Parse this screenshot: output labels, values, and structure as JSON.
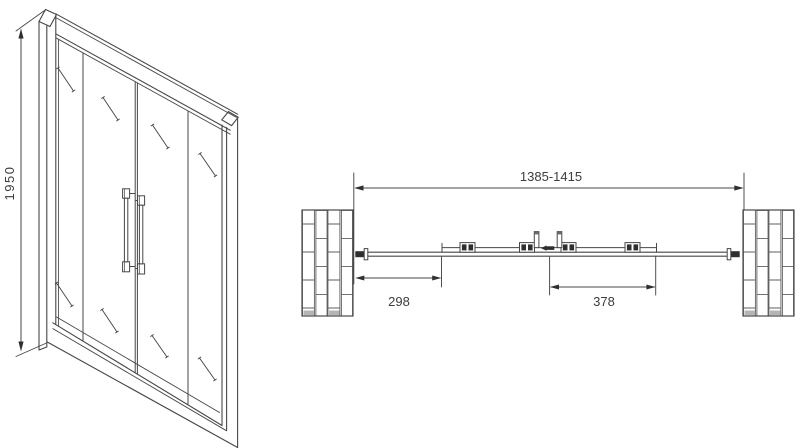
{
  "drawing": {
    "colors": {
      "background": "#ffffff",
      "line": "#474747",
      "brick_line": "#5f5f5f",
      "dark_fill": "#2f2f2f",
      "text": "#3d3d3d"
    },
    "elevation": {
      "height_dim": "1950"
    },
    "plan": {
      "overall_width_dim": "1385-1415",
      "left_offset_dim": "298",
      "panel_width_dim": "378"
    }
  }
}
